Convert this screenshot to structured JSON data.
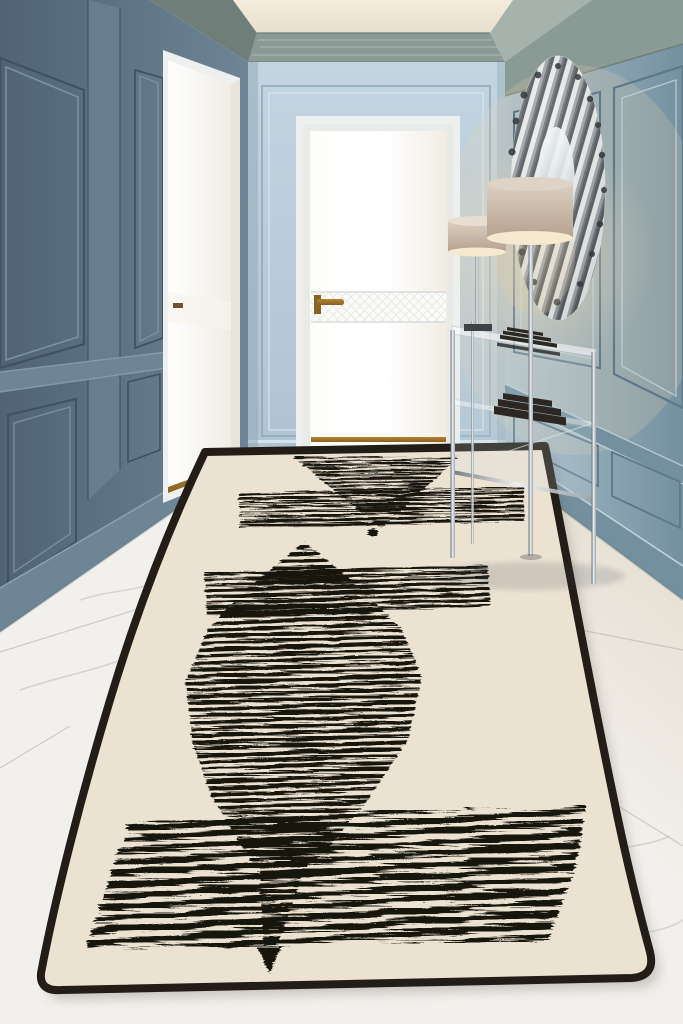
{
  "meta": {
    "title": "Hallway interior with cream geometric runner rug",
    "type": "interior-product-photo"
  },
  "palette": {
    "ceiling_a": "#f3ecdc",
    "ceiling_b": "#e9e0cc",
    "crown": "#8a9a94",
    "crown_dark": "#6f7e79",
    "crown_light": "#a6b3ac",
    "wall_end_a": "#c3d5e1",
    "wall_end_b": "#aec2d1",
    "wall_end_line_dark": "#8fa9ba",
    "wall_end_line_light": "#d6e3ec",
    "wall_left_a": "#4f6375",
    "wall_left_b": "#6e8595",
    "wall_left_line_dark": "#3f5264",
    "wall_left_line_light": "#8ba0af",
    "pilaster": "#73899a",
    "wall_right_a": "#a9bfcc",
    "wall_right_b": "#74909f",
    "wall_right_line_dark": "#5d7889",
    "wall_right_line_light": "#c2d2da",
    "door_white": "#fdfdfc",
    "door_warm": "#f1ede4",
    "door_frame": "#eef0ef",
    "door_shadow": "#d9dcda",
    "gold": "#b2832f",
    "gold_dark": "#8a6224",
    "marble_a": "#f2f0ec",
    "marble_b": "#e3dacb",
    "seam": "#b3ada4",
    "vein": "#c8c2b9",
    "rug_field": "#ece2d2",
    "rug_border": "#231d17",
    "ink": "#17130f",
    "chrome_a": "#eef1f2",
    "chrome_b": "#9aa4ab",
    "chrome_c": "#5f6a72",
    "shade_a": "#dccfc0",
    "shade_b": "#b5a290",
    "shade_lit": "#f6e9cf",
    "glow": "#f5e3bd",
    "books": "#2c2723",
    "silver_a": "#f0f1f0",
    "silver_b": "#aab0b2",
    "silver_c": "#41474b",
    "mirror": "#cfd9de"
  },
  "scene": {
    "root_label": "Hallway with blue paneled walls, white doors, chrome decor and a cream runner rug with black stripe geometry",
    "ceiling": {
      "label": "Cream ceiling panel with sage crown molding"
    },
    "walls": {
      "left": "Slate blue paneled wall with white side door",
      "end": "Light blue end wall with molding frame",
      "right": "Slate blue paneled wall with decor"
    },
    "doors": {
      "left": "White side door with brass handle and gold base trim",
      "center": "White hallway door with quilted band and brass lever handle"
    },
    "decor": {
      "sculpture": "Round chrome ribbon wall sculpture",
      "floor_lamp": "Taupe drum-shade floor lamp with chrome pole",
      "table_lamp": "Taupe drum-shade table lamp",
      "console": "Glass and chrome console table with dark book stacks"
    },
    "floor": {
      "label": "White marble tile floor with soft veining"
    },
    "rug": {
      "label": "Cream runner rug with black distressed-stripe motifs and dark border",
      "motifs": [
        "inverted striped triangle",
        "striped band",
        "small solid dot",
        "striped pyramid apex",
        "wide striped band",
        "elongated striped diamond",
        "tapering striped tail",
        "solid arrow tip",
        "large striped band"
      ]
    }
  }
}
